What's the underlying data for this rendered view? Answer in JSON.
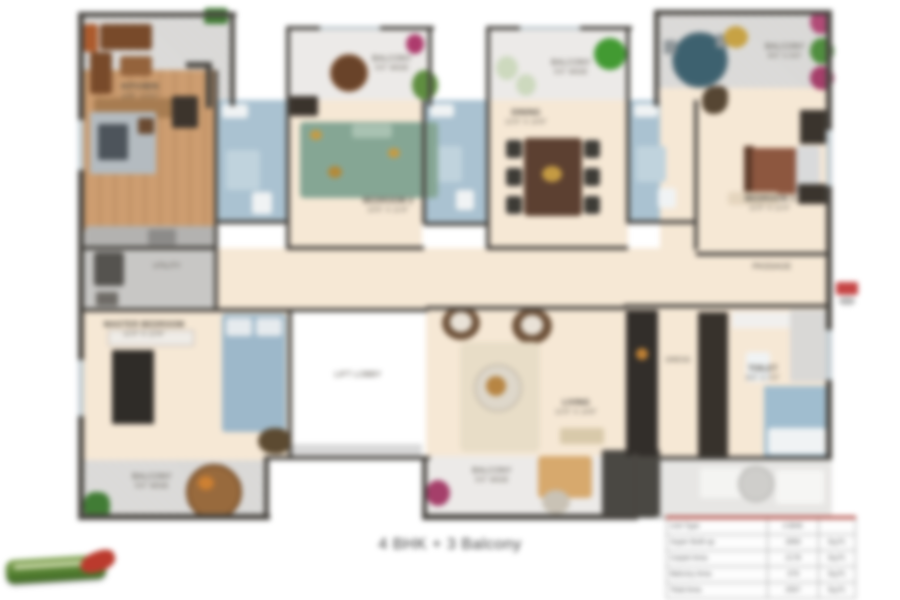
{
  "caption": "4 BHK + 3 Balcony",
  "rooms": {
    "kitchen": {
      "name": "KITCHEN",
      "dim": "10'6\" X 8'0\""
    },
    "bedroom2": {
      "name": "BEDROOM 2",
      "dim": "10'0\" X 11'6\""
    },
    "bedroom3": {
      "name": "BEDROOM 3",
      "dim": "11'0\" X 12'0\""
    },
    "master_bedroom": {
      "name": "MASTER BEDROOM",
      "dim": "11'0\" X 12'6\""
    },
    "dining": {
      "name": "DINING",
      "dim": "12'0\" X 10'6\""
    },
    "living": {
      "name": "LIVING",
      "dim": "12'0\" X 14'6\""
    },
    "lift": {
      "name": "LIFT LOBBY"
    },
    "passage": {
      "name": "PASSAGE"
    },
    "utility": {
      "name": "UTILITY"
    },
    "toilet": {
      "name": "TOILET",
      "dim": "8'0\" X 5'0\""
    },
    "dress": {
      "name": "DRESS"
    }
  },
  "balconies": [
    {
      "name": "BALCONY",
      "dim": "5'0\" WIDE"
    },
    {
      "name": "BALCONY",
      "dim": "5'0\" WIDE"
    },
    {
      "name": "BALCONY",
      "dim": "8'0\" X 6'0\""
    },
    {
      "name": "BALCONY",
      "dim": "5'0\" WIDE"
    },
    {
      "name": "BALCONY",
      "dim": "5'0\" WIDE"
    }
  ],
  "area_table": {
    "rows": [
      {
        "label": "Unit Type",
        "value": "4 BHK",
        "unit": ""
      },
      {
        "label": "Super Built-up",
        "value": "2850",
        "unit": "Sq.Ft."
      },
      {
        "label": "Carpet Area",
        "value": "2178",
        "unit": "Sq.Ft."
      },
      {
        "label": "Balcony Area",
        "value": "379",
        "unit": "Sq.Ft."
      },
      {
        "label": "Total Area",
        "value": "2557",
        "unit": "Sq.Ft."
      }
    ]
  }
}
